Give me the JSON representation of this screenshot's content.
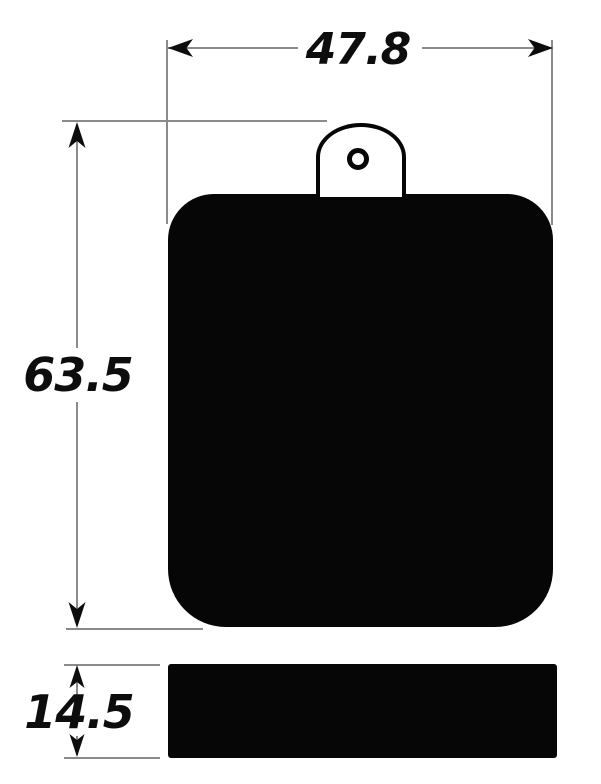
{
  "drawing": {
    "dimensions": {
      "width_label": "47.8",
      "height_label": "63.5",
      "thickness_label": "14.5"
    },
    "views": {
      "front": "pad-front-view",
      "side": "pad-side-view"
    },
    "colors": {
      "ink": "#0d0d0d",
      "line": "#8b8b8b",
      "part_fill": "#060606",
      "background": "#ffffff"
    }
  }
}
